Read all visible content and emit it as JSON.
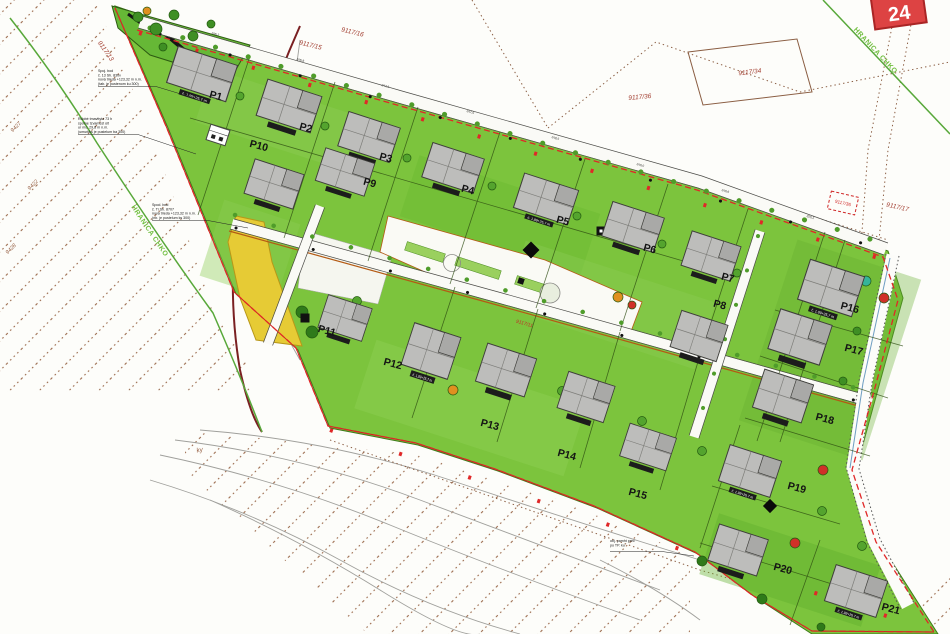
{
  "badge": "24",
  "boundary_label": "HRANICA CHKO",
  "plots": [
    "P1",
    "P2",
    "P3",
    "P4",
    "P5",
    "P6",
    "P7",
    "P8",
    "P9",
    "P10",
    "P11",
    "P12",
    "P13",
    "P14",
    "P15",
    "P16",
    "P17",
    "P18",
    "P19",
    "P20",
    "P21"
  ],
  "parcels": {
    "p13": "9117/13",
    "p15": "9117/15",
    "p16": "9117/16",
    "p17": "9117/17",
    "p34": "9117/34",
    "p36": "9117/36",
    "p36_red": "9117/36",
    "p11": "9117/11",
    "n9427": "9427",
    "n9422": "9422",
    "n9428": "9428",
    "ky": "ky"
  },
  "house_label": "č. 1,99+25,7 m",
  "annotations": {
    "a1": [
      "Spoj. bod",
      "č. 13 Sh. 830v",
      "nová trieda +123,32 m n.m.",
      "(tab. je pustenom ku 300)"
    ],
    "a2": [
      "Rdobé tmavttyta 73 h",
      "spome tzvamest últ",
      "ur mo. 29,8 m n.m.",
      "(umurkks je pustelum ba 300)"
    ],
    "a3": [
      "Spod. bod",
      "č. Ti Sh. 8707",
      "nová trieda +123,32 m n.m.",
      "(nb. je pustelum ks 300)"
    ],
    "a4": [
      "obj. pamht prec",
      "po TP. ku"
    ]
  },
  "elevations": [
    "246,2",
    "246,8",
    "247,3",
    "247,9",
    "248,5",
    "249,0",
    "249,6",
    "250,2"
  ]
}
